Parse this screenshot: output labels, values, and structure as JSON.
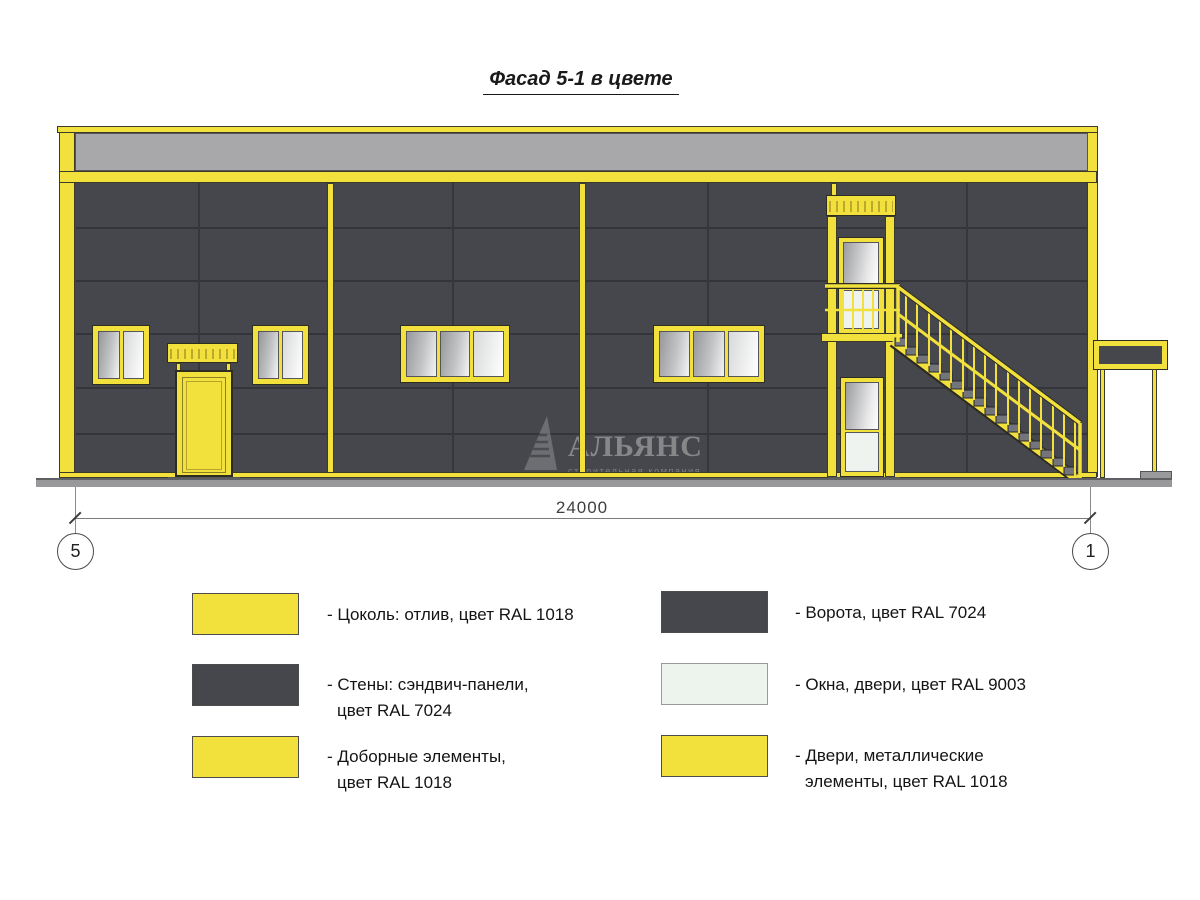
{
  "title": "Фасад 5-1 в цвете",
  "dimension": {
    "length": "24000",
    "axis_left": "5",
    "axis_right": "1"
  },
  "watermark": {
    "name": "АЛЬЯНС",
    "subtitle": "строительная компания"
  },
  "legend": {
    "left": [
      {
        "color": "#F2E03C",
        "line1": "- Цоколь: отлив, цвет RAL 1018",
        "line2": ""
      },
      {
        "color": "#45474D",
        "line1": "- Стены: сэндвич-панели,",
        "line2": "цвет RAL 7024"
      },
      {
        "color": "#F2E03C",
        "line1": "- Доборные элементы,",
        "line2": "цвет RAL 1018"
      }
    ],
    "right": [
      {
        "color": "#45474D",
        "line1": "- Ворота, цвет RAL 7024",
        "line2": ""
      },
      {
        "color": "#EDF3ED",
        "line1": "- Окна, двери, цвет RAL 9003",
        "line2": ""
      },
      {
        "color": "#F2E03C",
        "line1": "- Двери, металлические",
        "line2": "элементы, цвет RAL 1018"
      }
    ]
  },
  "colors": {
    "accent_yellow": "#F2E03C",
    "wall_gray": "#45474D",
    "parapet_gray": "#A8A8AA",
    "window_white": "#EDF3ED",
    "ground_gray": "#98989A"
  }
}
